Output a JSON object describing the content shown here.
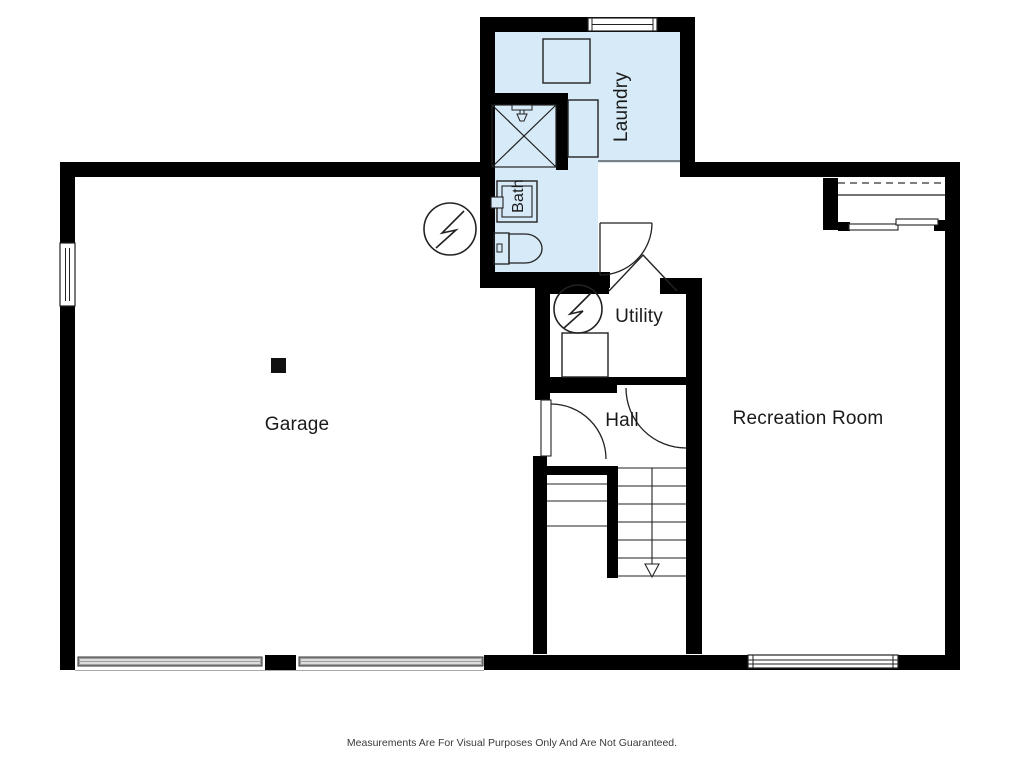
{
  "meta": {
    "type": "basement-floor-plan"
  },
  "labels": {
    "laundry": "Laundry",
    "bath": "Bath",
    "utility": "Utility",
    "hall": "Hall",
    "garage": "Garage",
    "recreation_room": "Recreation Room"
  },
  "footer": {
    "disclaimer": "Measurements Are For Visual Purposes Only And Are Not Guaranteed."
  },
  "colors": {
    "wall": "#000000",
    "wet_room_fill": "#d6eaf8",
    "line": "#222222",
    "label_text": "#1a1a1a",
    "disclaimer_text": "#3a3a3a",
    "garage_door_gray": "#a0a0a0",
    "background": "#ffffff"
  },
  "symbols": [
    "furnace-icon",
    "shower-icon",
    "shower-head-icon",
    "toilet-icon",
    "sink-vanity-icon",
    "washer-icon",
    "appliance-icon",
    "stairs",
    "stairs-down-arrow-icon",
    "window",
    "door-swing",
    "open-door-icon",
    "sliding-closet-door",
    "closet-rod-dashed-line",
    "support-column"
  ]
}
